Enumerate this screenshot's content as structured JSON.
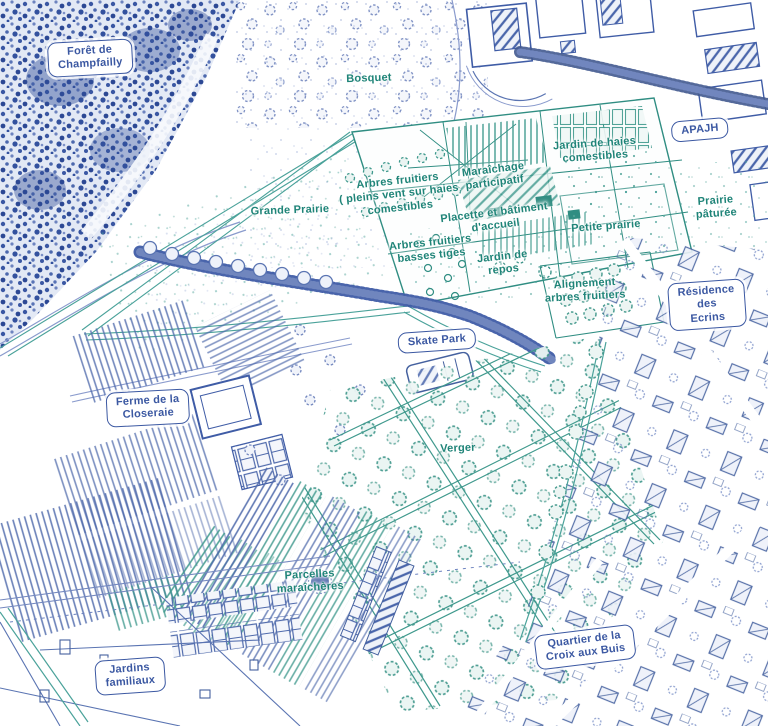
{
  "map": {
    "palette": {
      "ink_blue": "#3b58a2",
      "ink_teal": "#1f8478",
      "light_blue": "#7d92c8",
      "light_teal": "#4aa29a"
    },
    "labels": [
      {
        "id": "foret-de-champfailly",
        "kind": "badge",
        "color": "blue",
        "text": "Forêt de\nChampfailly",
        "x": 90,
        "y": 58,
        "rot": -3
      },
      {
        "id": "bosquet",
        "kind": "text",
        "color": "teal",
        "text": "Bosquet",
        "x": 369,
        "y": 79,
        "rot": -2
      },
      {
        "id": "apajh",
        "kind": "badge",
        "color": "blue",
        "text": "APAJH",
        "x": 700,
        "y": 130,
        "rot": -5
      },
      {
        "id": "jardin-de-haies-comestibles",
        "kind": "text",
        "color": "teal",
        "text": "Jardin de haies\ncomestibles",
        "x": 595,
        "y": 151,
        "rot": -4
      },
      {
        "id": "maraichage-participatif",
        "kind": "text",
        "color": "teal",
        "text": "Maraîchage\nparticipatif",
        "x": 494,
        "y": 177,
        "rot": -7
      },
      {
        "id": "arbres-fruitiers-pleins-vent",
        "kind": "text",
        "color": "teal",
        "text": "Arbres fruitiers\n( pleins vent sur haies\ncomestibles",
        "x": 399,
        "y": 195,
        "rot": -6
      },
      {
        "id": "grande-prairie",
        "kind": "text",
        "color": "teal",
        "text": "Grande Prairie",
        "x": 290,
        "y": 211,
        "rot": -2
      },
      {
        "id": "placette-batiment-accueil",
        "kind": "text",
        "color": "teal",
        "text": "Placette et bâtiment\nd'accueil",
        "x": 495,
        "y": 220,
        "rot": -7
      },
      {
        "id": "petite-prairie",
        "kind": "text",
        "color": "teal",
        "text": "Petite prairie",
        "x": 606,
        "y": 227,
        "rot": -4
      },
      {
        "id": "prairie-paturee",
        "kind": "text",
        "color": "teal",
        "text": "Prairie pâturée",
        "x": 716,
        "y": 208,
        "rot": -4
      },
      {
        "id": "arbres-fruitiers-basses-tiges",
        "kind": "text",
        "color": "teal",
        "text": "Arbres fruitiers\nbasses tiges",
        "x": 431,
        "y": 250,
        "rot": -6
      },
      {
        "id": "jardin-de-repos",
        "kind": "text",
        "color": "teal",
        "text": "Jardin de\nrepos",
        "x": 503,
        "y": 264,
        "rot": -6
      },
      {
        "id": "alignement-arbres-fruitiers",
        "kind": "text",
        "color": "teal",
        "text": "Alignement\narbres fruitiers",
        "x": 585,
        "y": 291,
        "rot": -3
      },
      {
        "id": "residence-des-ecrins",
        "kind": "badge",
        "color": "blue",
        "text": "Résidence des\nEcrins",
        "x": 707,
        "y": 305,
        "rot": -4
      },
      {
        "id": "skate-park",
        "kind": "badge",
        "color": "blue",
        "text": "Skate Park",
        "x": 437,
        "y": 341,
        "rot": -4
      },
      {
        "id": "ferme-de-la-closeraie",
        "kind": "badge",
        "color": "blue",
        "text": "Ferme de la\nCloseraie",
        "x": 148,
        "y": 408,
        "rot": -3
      },
      {
        "id": "verger",
        "kind": "text",
        "color": "teal",
        "text": "Verger",
        "x": 458,
        "y": 449,
        "rot": -2
      },
      {
        "id": "parcelles-maraicheres",
        "kind": "text",
        "color": "teal",
        "text": "Parcelles\nmaraîchères",
        "x": 310,
        "y": 582,
        "rot": -3
      },
      {
        "id": "jardins-familiaux",
        "kind": "badge",
        "color": "blue",
        "text": "Jardins\nfamiliaux",
        "x": 130,
        "y": 676,
        "rot": -4
      },
      {
        "id": "quartier-croix-aux-buis",
        "kind": "badge",
        "color": "blue",
        "text": "Quartier de la\nCroix aux Buis",
        "x": 585,
        "y": 647,
        "rot": -7
      }
    ]
  }
}
